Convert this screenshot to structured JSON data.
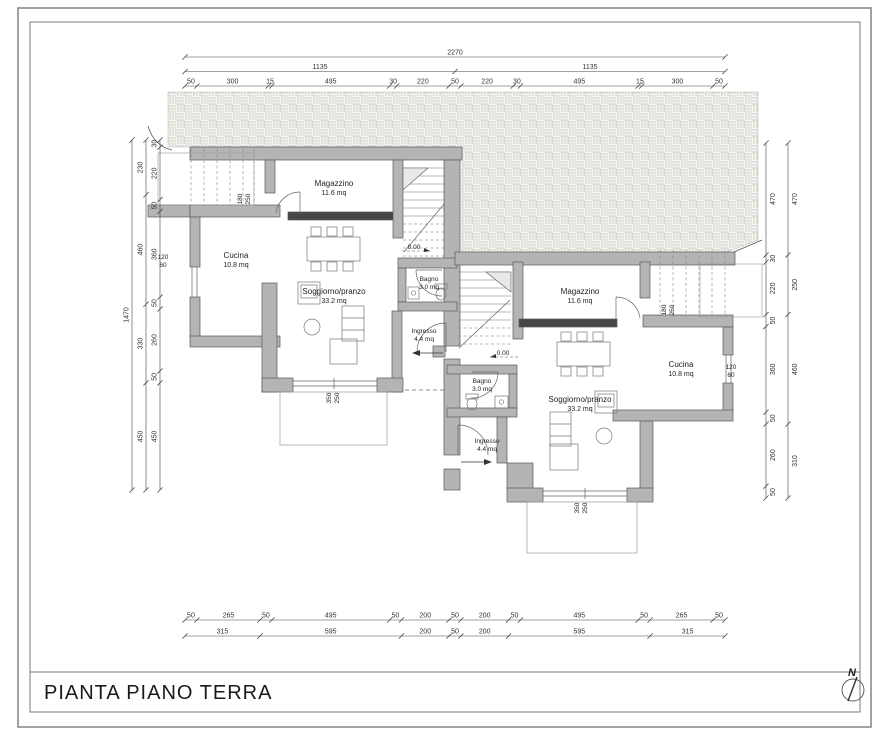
{
  "page": {
    "title": "PIANTA PIANO TERRA",
    "north_label": "N"
  },
  "units": {
    "left": {
      "rooms": [
        {
          "name": "Magazzino",
          "area": "11.6 mq"
        },
        {
          "name": "Cucina",
          "area": "10.8 mq"
        },
        {
          "name": "Soggiorno/pranzo",
          "area": "33.2 mq"
        },
        {
          "name": "Bagno",
          "area": "3.0 mq"
        },
        {
          "name": "Ingresso",
          "area": "4.4 mq"
        }
      ],
      "level": "0.00",
      "door_label": [
        "180",
        "250"
      ],
      "window_label": [
        "120",
        "60"
      ],
      "terrace_door_label": [
        "350",
        "250"
      ]
    },
    "right": {
      "rooms": [
        {
          "name": "Magazzino",
          "area": "11.6 mq"
        },
        {
          "name": "Cucina",
          "area": "10.8 mq"
        },
        {
          "name": "Soggiorno/pranzo",
          "area": "33.2 mq"
        },
        {
          "name": "Bagno",
          "area": "3.0 mq"
        },
        {
          "name": "Ingresso",
          "area": "4.4 mq"
        }
      ],
      "level": "0.00",
      "door_label": [
        "180",
        "250"
      ],
      "window_label": [
        "120",
        "60"
      ],
      "terrace_door_label": [
        "350",
        "250"
      ]
    }
  },
  "dimensions": {
    "top": {
      "total": "2270",
      "halves": [
        "1135",
        "1135"
      ],
      "segments": [
        "50",
        "300",
        "15",
        "495",
        "30",
        "220",
        "50",
        "220",
        "30",
        "495",
        "15",
        "300",
        "50"
      ]
    },
    "bottom": {
      "row1": [
        "50",
        "265",
        "50",
        "495",
        "50",
        "200",
        "50",
        "200",
        "50",
        "495",
        "50",
        "265",
        "50"
      ],
      "row2": [
        "315",
        "595",
        "200",
        "50",
        "200",
        "595",
        "315"
      ]
    },
    "left": {
      "total": "1470",
      "outer": [
        "230",
        "460",
        "330",
        "450"
      ],
      "inner": [
        "30",
        "220",
        "50",
        "360",
        "50",
        "260",
        "50",
        "450"
      ]
    },
    "right": {
      "inner": [
        "470",
        "30",
        "220",
        "50",
        "360",
        "50",
        "260",
        "50"
      ],
      "outer": [
        "470",
        "250",
        "460",
        "310"
      ]
    }
  }
}
